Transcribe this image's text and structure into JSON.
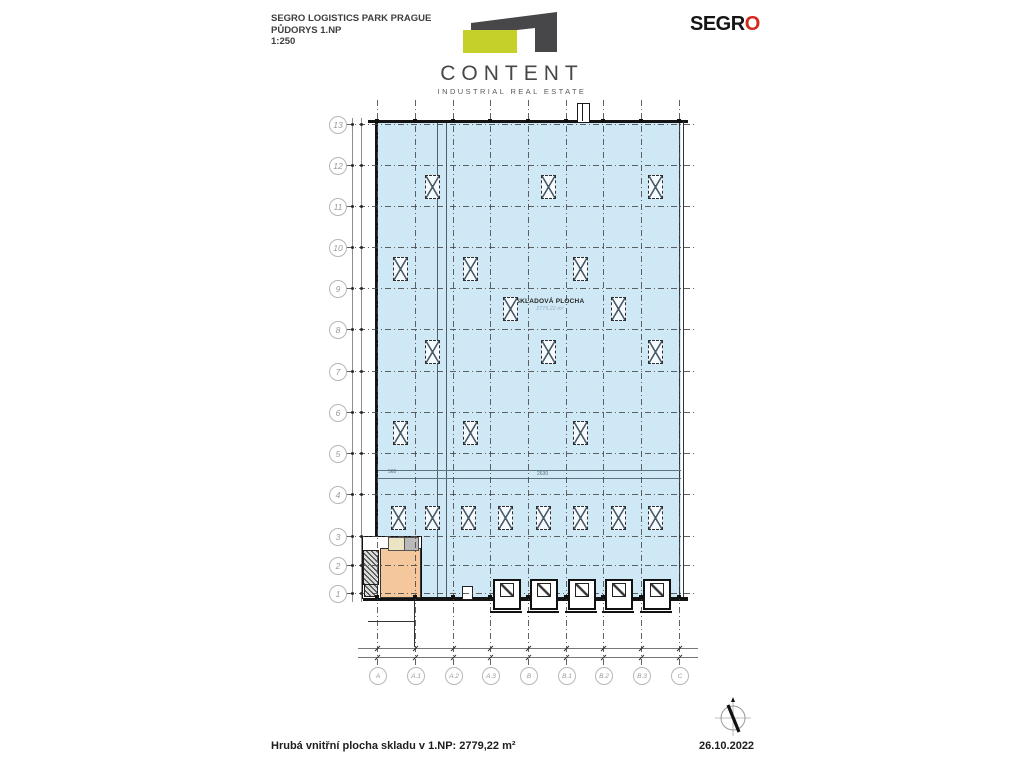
{
  "header": {
    "title_line1": "SEGRO LOGISTICS PARK PRAGUE",
    "title_line2": "PŮDORYS 1.NP",
    "title_line3": "1:250",
    "content_logo": {
      "name": "CONTENT",
      "subtitle": "INDUSTRIAL REAL ESTATE"
    },
    "segro_logo": {
      "text": "SEGR",
      "o": "O"
    }
  },
  "plan": {
    "warehouse_label": {
      "name": "SKLADOVÁ PLOCHA",
      "area": "2779,22 m²"
    },
    "axes": {
      "rows": [
        {
          "label": "13",
          "y": 124
        },
        {
          "label": "12",
          "y": 165
        },
        {
          "label": "11",
          "y": 206
        },
        {
          "label": "10",
          "y": 247
        },
        {
          "label": "9",
          "y": 288
        },
        {
          "label": "8",
          "y": 329
        },
        {
          "label": "7",
          "y": 371
        },
        {
          "label": "6",
          "y": 412
        },
        {
          "label": "5",
          "y": 453
        },
        {
          "label": "4",
          "y": 494
        },
        {
          "label": "3",
          "y": 536
        },
        {
          "label": "2",
          "y": 565
        },
        {
          "label": "1",
          "y": 593
        }
      ],
      "cols": [
        {
          "label": "A",
          "x": 377
        },
        {
          "label": "A.1",
          "x": 415
        },
        {
          "label": "A.2",
          "x": 453
        },
        {
          "label": "A.3",
          "x": 490
        },
        {
          "label": "B",
          "x": 528
        },
        {
          "label": "B.1",
          "x": 566
        },
        {
          "label": "B.2",
          "x": 603
        },
        {
          "label": "B.3",
          "x": 641
        },
        {
          "label": "C",
          "x": 679
        }
      ]
    },
    "skylights": [
      {
        "x": 432,
        "y": 186
      },
      {
        "x": 548,
        "y": 186
      },
      {
        "x": 655,
        "y": 186
      },
      {
        "x": 400,
        "y": 268
      },
      {
        "x": 470,
        "y": 268
      },
      {
        "x": 580,
        "y": 268
      },
      {
        "x": 510,
        "y": 308
      },
      {
        "x": 618,
        "y": 308
      },
      {
        "x": 432,
        "y": 351
      },
      {
        "x": 548,
        "y": 351
      },
      {
        "x": 655,
        "y": 351
      },
      {
        "x": 400,
        "y": 432
      },
      {
        "x": 470,
        "y": 432
      },
      {
        "x": 580,
        "y": 432
      },
      {
        "x": 398,
        "y": 517
      },
      {
        "x": 432,
        "y": 517
      },
      {
        "x": 468,
        "y": 517
      },
      {
        "x": 505,
        "y": 517
      },
      {
        "x": 543,
        "y": 517
      },
      {
        "x": 580,
        "y": 517
      },
      {
        "x": 618,
        "y": 517
      },
      {
        "x": 655,
        "y": 517
      }
    ],
    "docks": [
      505,
      542,
      580,
      617,
      655
    ],
    "dim_labels": [
      {
        "text": "560",
        "x": 388,
        "y": 470
      },
      {
        "text": "2630",
        "x": 537,
        "y": 472
      }
    ]
  },
  "footer": {
    "area_text": "Hrubá vnitřní plocha skladu v 1.NP: 2779,22 m²",
    "date": "26.10.2022"
  },
  "colors": {
    "hall_fill": "#cfe8f5",
    "office_fill": "#f4c79c",
    "room_yellow": "#ece5c4",
    "room_gray": "#b9b9bb",
    "logo_dark": "#47474a",
    "logo_lime": "#c6d02b",
    "segro_red": "#d5281b"
  }
}
